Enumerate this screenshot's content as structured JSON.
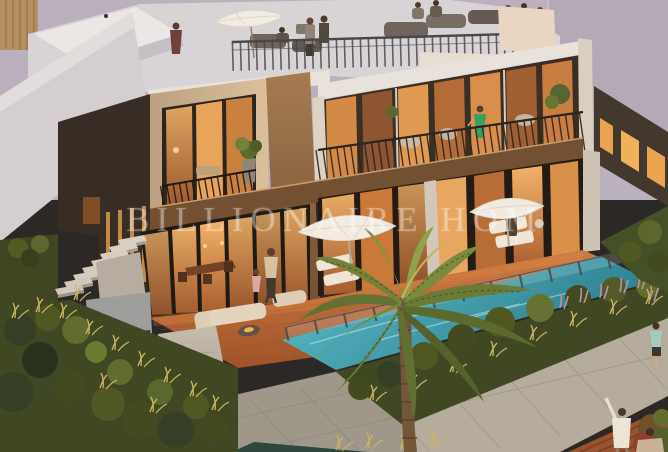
{
  "image": {
    "type": "architectural-render",
    "subject": "modern two-storey townhouse villas with rooftop terrace, balconies, swimming pool, terracotta patio, palm tree and landscaped garden at dusk"
  },
  "watermark": {
    "text": "BILLIONAIRE HOM",
    "color": "#ffffff",
    "opacity": 0.3
  },
  "palette": {
    "sky": "#b9b2c2",
    "background_wall": "#b1abba",
    "building_light": "#e9e6e1",
    "building_cream": "#cdb18c",
    "facade_dark": "#2f2822",
    "bronze": "#8a6342",
    "glass_warm": "#e8a458",
    "patio_terracotta": "#c06a3a",
    "pool": "#3fa8bc",
    "foliage_dark": "#36441f",
    "grass_gold": "#cfba62",
    "feather_grass": "#b794ac",
    "path_stone": "#b3ada2",
    "railing": "#43424a",
    "umbrella": "#f3f0e9",
    "deck_wood": "#93502e"
  },
  "scene": {
    "elements": [
      "background-building-with-lit-windows",
      "rooftop-terrace-with-people-and-umbrella",
      "second-floor-balconies",
      "woman-in-green-dress-on-balcony",
      "ground-floor-glass-doors-lit-interior",
      "terracotta-patio",
      "adult-and-child-walking-on-patio",
      "outdoor-lounge-with-fire-pit",
      "sun-loungers",
      "patio-umbrellas",
      "swimming-pool-with-glass-fence",
      "palm-tree",
      "ornamental-grasses-and-shrubs",
      "stone-pathway",
      "garden-stairs-and-gate",
      "pedestrians-on-path"
    ]
  }
}
